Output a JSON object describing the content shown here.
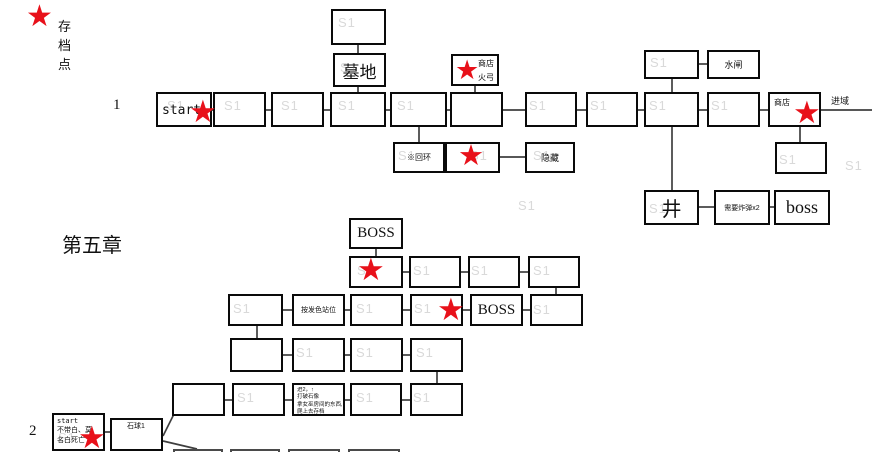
{
  "legend": {
    "star": "★",
    "label": "存档点"
  },
  "star_glyph": "★",
  "watermark_text": "S1",
  "colors": {
    "star_red": "#e8111a",
    "line": "#3f3f3f",
    "border": "#0a0a0a"
  },
  "section_labels": [
    {
      "name": "row1-number",
      "text": "1",
      "x": 113,
      "y": 97,
      "s": 15,
      "f": "serif"
    },
    {
      "name": "chapter5-title",
      "text": "第五章",
      "x": 62,
      "y": 229,
      "s": 20,
      "f": "sans"
    },
    {
      "name": "row2-number",
      "text": "2",
      "x": 29,
      "y": 423,
      "s": 15,
      "f": "serif"
    }
  ],
  "exit_label": {
    "text": "进域",
    "x": 831,
    "y": 94,
    "s": 9
  },
  "boxes": [
    {
      "name": "box-ch1-top",
      "x": 331,
      "y": 9,
      "w": 55,
      "h": 36
    },
    {
      "name": "box-cemetery",
      "x": 333,
      "y": 53,
      "w": 53,
      "h": 34,
      "label": {
        "t": "墓地",
        "s": 17
      }
    },
    {
      "name": "box-shop-firebow",
      "x": 451,
      "y": 54,
      "w": 48,
      "h": 32,
      "sub": [
        {
          "t": "商店",
          "dx": 25,
          "dy": 4,
          "s": 8
        },
        {
          "t": "火弓",
          "dx": 25,
          "dy": 18,
          "s": 8
        }
      ]
    },
    {
      "name": "box-start-ch1",
      "x": 156,
      "y": 92,
      "w": 56,
      "h": 35,
      "sub": [
        {
          "t": "start",
          "dx": 4,
          "dy": 10,
          "s": 13,
          "f": "mono"
        }
      ]
    },
    {
      "name": "box-r1-2",
      "x": 213,
      "y": 92,
      "w": 53,
      "h": 35
    },
    {
      "name": "box-r1-3",
      "x": 271,
      "y": 92,
      "w": 53,
      "h": 35
    },
    {
      "name": "box-r1-4",
      "x": 330,
      "y": 92,
      "w": 56,
      "h": 35
    },
    {
      "name": "box-r1-5",
      "x": 390,
      "y": 92,
      "w": 57,
      "h": 35
    },
    {
      "name": "box-r1-6",
      "x": 450,
      "y": 92,
      "w": 53,
      "h": 35
    },
    {
      "name": "box-r1-7",
      "x": 525,
      "y": 92,
      "w": 52,
      "h": 35
    },
    {
      "name": "box-r1-8",
      "x": 586,
      "y": 92,
      "w": 52,
      "h": 35
    },
    {
      "name": "box-r1-9",
      "x": 644,
      "y": 92,
      "w": 55,
      "h": 35
    },
    {
      "name": "box-r1-10",
      "x": 707,
      "y": 92,
      "w": 53,
      "h": 35
    },
    {
      "name": "box-shop-right",
      "x": 768,
      "y": 92,
      "w": 53,
      "h": 35,
      "sub": [
        {
          "t": "商店",
          "dx": 4,
          "dy": 5,
          "s": 8
        }
      ]
    },
    {
      "name": "box-watergate-left",
      "x": 644,
      "y": 50,
      "w": 55,
      "h": 29
    },
    {
      "name": "box-watergate",
      "x": 707,
      "y": 50,
      "w": 53,
      "h": 29,
      "label": {
        "t": "水闸",
        "s": 9
      }
    },
    {
      "name": "box-loop",
      "x": 393,
      "y": 142,
      "w": 52,
      "h": 31,
      "label": {
        "t": "※回环",
        "s": 8
      }
    },
    {
      "name": "box-loop-star",
      "x": 445,
      "y": 142,
      "w": 55,
      "h": 31
    },
    {
      "name": "box-hidden",
      "x": 525,
      "y": 142,
      "w": 50,
      "h": 31,
      "label": {
        "t": "隐藏",
        "s": 9
      }
    },
    {
      "name": "box-above-boss",
      "x": 775,
      "y": 142,
      "w": 52,
      "h": 32
    },
    {
      "name": "box-well",
      "x": 644,
      "y": 190,
      "w": 55,
      "h": 35,
      "label": {
        "t": "井",
        "s": 20
      }
    },
    {
      "name": "box-need-bombs",
      "x": 714,
      "y": 190,
      "w": 56,
      "h": 35,
      "label": {
        "t": "需要炸弹x2",
        "s": 7
      }
    },
    {
      "name": "box-boss-ch1",
      "x": 774,
      "y": 190,
      "w": 56,
      "h": 35,
      "label": {
        "t": "boss",
        "s": 18,
        "f": "serif"
      }
    },
    {
      "name": "box-ch5-boss-top",
      "x": 349,
      "y": 218,
      "w": 54,
      "h": 31,
      "label": {
        "t": "BOSS",
        "s": 15,
        "f": "serif"
      }
    },
    {
      "name": "box-ch5-r2-1",
      "x": 349,
      "y": 256,
      "w": 54,
      "h": 32
    },
    {
      "name": "box-ch5-r2-2",
      "x": 409,
      "y": 256,
      "w": 52,
      "h": 32
    },
    {
      "name": "box-ch5-r2-3",
      "x": 468,
      "y": 256,
      "w": 52,
      "h": 32
    },
    {
      "name": "box-ch5-r2-4",
      "x": 528,
      "y": 256,
      "w": 52,
      "h": 32
    },
    {
      "name": "box-ch5-r3-1",
      "x": 228,
      "y": 294,
      "w": 55,
      "h": 32
    },
    {
      "name": "box-hair-color",
      "x": 292,
      "y": 294,
      "w": 53,
      "h": 32,
      "label": {
        "t": "按发色站位",
        "s": 7
      }
    },
    {
      "name": "box-ch5-r3-3",
      "x": 350,
      "y": 294,
      "w": 53,
      "h": 32
    },
    {
      "name": "box-ch5-r3-4",
      "x": 410,
      "y": 294,
      "w": 53,
      "h": 32
    },
    {
      "name": "box-ch5-boss2",
      "x": 470,
      "y": 294,
      "w": 53,
      "h": 32,
      "label": {
        "t": "BOSS",
        "s": 15,
        "f": "serif"
      }
    },
    {
      "name": "box-ch5-r3-6",
      "x": 530,
      "y": 294,
      "w": 53,
      "h": 32
    },
    {
      "name": "box-ch5-r4-1",
      "x": 230,
      "y": 338,
      "w": 53,
      "h": 34
    },
    {
      "name": "box-ch5-r4-2",
      "x": 292,
      "y": 338,
      "w": 53,
      "h": 34
    },
    {
      "name": "box-ch5-r4-3",
      "x": 350,
      "y": 338,
      "w": 53,
      "h": 34
    },
    {
      "name": "box-ch5-r4-4",
      "x": 410,
      "y": 338,
      "w": 53,
      "h": 34
    },
    {
      "name": "box-mb-1",
      "x": 172,
      "y": 383,
      "w": 53,
      "h": 33
    },
    {
      "name": "box-mb-2",
      "x": 232,
      "y": 383,
      "w": 53,
      "h": 33
    },
    {
      "name": "box-notes",
      "x": 292,
      "y": 383,
      "w": 53,
      "h": 33,
      "stack": {
        "lines": [
          "进2，↑",
          "打破石像",
          "拿女巫房间的东西从窗",
          "爬上去存档"
        ],
        "s": 5.5
      }
    },
    {
      "name": "box-mb-4",
      "x": 350,
      "y": 383,
      "w": 52,
      "h": 33
    },
    {
      "name": "box-mb-5",
      "x": 410,
      "y": 383,
      "w": 53,
      "h": 33
    },
    {
      "name": "box-start-ch2",
      "x": 52,
      "y": 413,
      "w": 53,
      "h": 38,
      "stack": {
        "lines": [
          "start",
          "不带白、莫",
          "名白死亡"
        ],
        "s": 7,
        "f": "mono"
      }
    },
    {
      "name": "box-stone-ball",
      "x": 110,
      "y": 418,
      "w": 53,
      "h": 33,
      "sub": [
        {
          "t": "石球1",
          "dx": 15,
          "dy": 3,
          "s": 7
        }
      ]
    },
    {
      "name": "box-bottom-1",
      "x": 173,
      "y": 449,
      "w": 50,
      "h": 12,
      "thin": true
    },
    {
      "name": "box-bottom-2",
      "x": 230,
      "y": 449,
      "w": 50,
      "h": 12,
      "thin": true
    },
    {
      "name": "box-bottom-3",
      "x": 288,
      "y": 449,
      "w": 52,
      "h": 12,
      "thin": true
    },
    {
      "name": "box-bottom-4",
      "x": 348,
      "y": 449,
      "w": 52,
      "h": 12,
      "thin": true
    }
  ],
  "stars": [
    {
      "name": "save-star-start1",
      "x": 189,
      "y": 97,
      "s": 31
    },
    {
      "name": "save-star-firebow",
      "x": 455,
      "y": 57,
      "s": 27
    },
    {
      "name": "save-star-loop",
      "x": 458,
      "y": 141,
      "s": 29
    },
    {
      "name": "save-star-shop-right",
      "x": 793,
      "y": 98,
      "s": 31
    },
    {
      "name": "save-star-ch5-row2",
      "x": 357,
      "y": 255,
      "s": 31
    },
    {
      "name": "save-star-ch5-row3",
      "x": 437,
      "y": 295,
      "s": 31
    },
    {
      "name": "save-star-start2",
      "x": 78,
      "y": 423,
      "s": 31
    }
  ],
  "lines": [
    [
      358,
      45,
      358,
      53
    ],
    [
      358,
      87,
      358,
      92
    ],
    [
      475,
      86,
      475,
      92
    ],
    [
      672,
      79,
      672,
      92
    ],
    [
      699,
      64,
      707,
      64
    ],
    [
      212,
      110,
      214,
      110
    ],
    [
      266,
      110,
      271,
      110
    ],
    [
      324,
      110,
      330,
      110
    ],
    [
      386,
      110,
      390,
      110
    ],
    [
      447,
      110,
      450,
      110
    ],
    [
      503,
      110,
      525,
      110
    ],
    [
      577,
      110,
      586,
      110
    ],
    [
      638,
      110,
      644,
      110
    ],
    [
      699,
      110,
      707,
      110
    ],
    [
      760,
      110,
      768,
      110
    ],
    [
      821,
      110,
      872,
      110
    ],
    [
      419,
      127,
      419,
      142
    ],
    [
      800,
      127,
      800,
      142
    ],
    [
      672,
      127,
      672,
      190
    ],
    [
      500,
      157,
      525,
      157
    ],
    [
      699,
      207,
      714,
      207
    ],
    [
      770,
      207,
      774,
      207
    ],
    [
      376,
      249,
      376,
      256
    ],
    [
      403,
      272,
      409,
      272
    ],
    [
      461,
      272,
      468,
      272
    ],
    [
      520,
      272,
      528,
      272
    ],
    [
      556,
      288,
      556,
      294
    ],
    [
      283,
      310,
      292,
      310
    ],
    [
      345,
      310,
      350,
      310
    ],
    [
      403,
      310,
      410,
      310
    ],
    [
      463,
      310,
      470,
      310
    ],
    [
      523,
      310,
      530,
      310
    ],
    [
      257,
      326,
      257,
      338
    ],
    [
      283,
      355,
      292,
      355
    ],
    [
      345,
      355,
      350,
      355
    ],
    [
      403,
      355,
      410,
      355
    ],
    [
      437,
      372,
      437,
      383
    ],
    [
      225,
      400,
      232,
      400
    ],
    [
      285,
      400,
      292,
      400
    ],
    [
      345,
      400,
      350,
      400
    ],
    [
      402,
      400,
      410,
      400
    ],
    [
      105,
      432,
      110,
      432
    ],
    [
      163,
      436,
      174,
      414
    ],
    [
      163,
      441,
      197,
      449
    ]
  ],
  "watermarks": [
    [
      338,
      15
    ],
    [
      340,
      60
    ],
    [
      650,
      55
    ],
    [
      167,
      98
    ],
    [
      224,
      98
    ],
    [
      281,
      98
    ],
    [
      338,
      98
    ],
    [
      397,
      98
    ],
    [
      529,
      98
    ],
    [
      590,
      98
    ],
    [
      649,
      98
    ],
    [
      711,
      98
    ],
    [
      398,
      148
    ],
    [
      470,
      148
    ],
    [
      533,
      148
    ],
    [
      779,
      152
    ],
    [
      845,
      158
    ],
    [
      649,
      201
    ],
    [
      518,
      198
    ],
    [
      357,
      263
    ],
    [
      413,
      263
    ],
    [
      471,
      263
    ],
    [
      533,
      263
    ],
    [
      233,
      301
    ],
    [
      356,
      301
    ],
    [
      414,
      301
    ],
    [
      533,
      302
    ],
    [
      296,
      345
    ],
    [
      356,
      345
    ],
    [
      416,
      345
    ],
    [
      237,
      390
    ],
    [
      356,
      390
    ],
    [
      413,
      390
    ],
    [
      58,
      430
    ]
  ]
}
